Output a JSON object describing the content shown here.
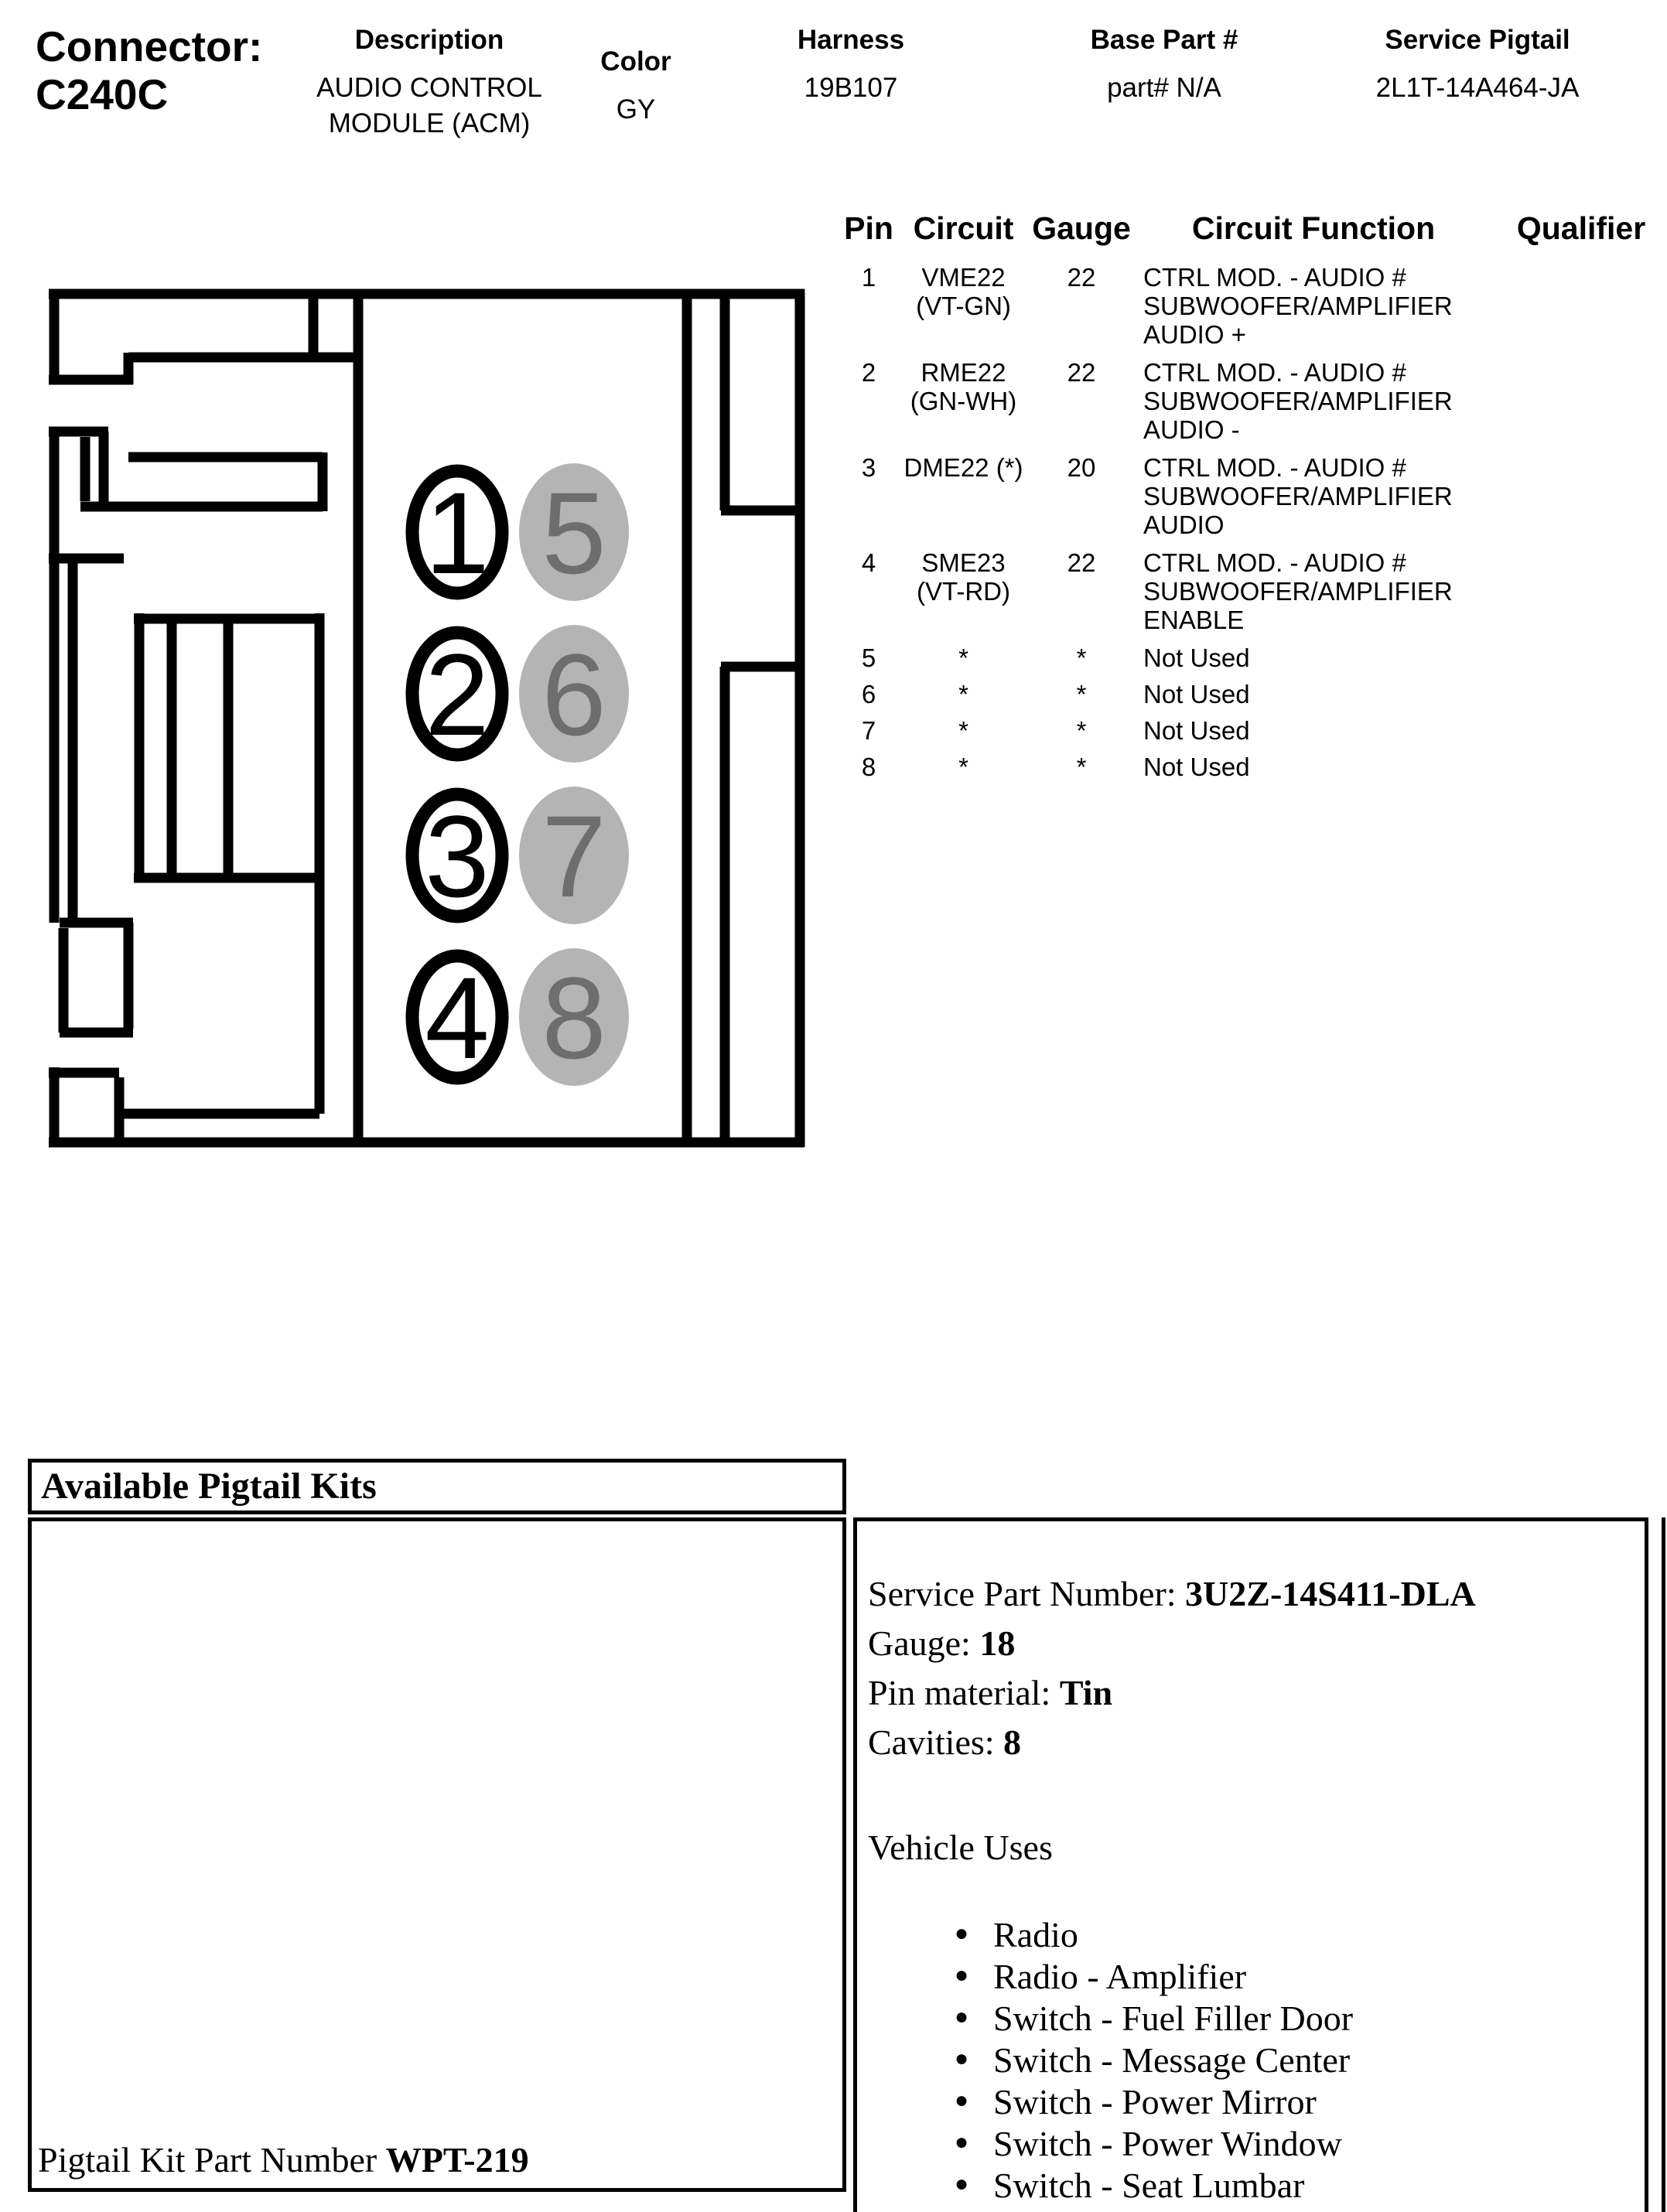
{
  "header": {
    "connector_label": "Connector:",
    "connector_id": "C240C",
    "description_label": "Description",
    "description_line1": "AUDIO CONTROL",
    "description_line2": "MODULE (ACM)",
    "color_label": "Color",
    "color_value": "GY",
    "harness_label": "Harness",
    "harness_value": "19B107",
    "base_part_label": "Base Part #",
    "base_part_value": "part# N/A",
    "service_pigtail_label": "Service Pigtail",
    "service_pigtail_value": "2L1T-14A464-JA"
  },
  "pin_table": {
    "headers": [
      "Pin",
      "Circuit",
      "Gauge",
      "Circuit Function",
      "Qualifier"
    ],
    "rows": [
      {
        "pin": "1",
        "circuit": [
          "VME22",
          "(VT-GN)"
        ],
        "gauge": "22",
        "function": [
          "CTRL MOD. - AUDIO #",
          "SUBWOOFER/AMPLIFIER",
          "AUDIO +"
        ],
        "qualifier": ""
      },
      {
        "pin": "2",
        "circuit": [
          "RME22",
          "(GN-WH)"
        ],
        "gauge": "22",
        "function": [
          "CTRL MOD. - AUDIO #",
          "SUBWOOFER/AMPLIFIER",
          "AUDIO -"
        ],
        "qualifier": ""
      },
      {
        "pin": "3",
        "circuit": [
          "DME22 (*)"
        ],
        "gauge": "20",
        "function": [
          "CTRL MOD. - AUDIO #",
          "SUBWOOFER/AMPLIFIER",
          "AUDIO"
        ],
        "qualifier": ""
      },
      {
        "pin": "4",
        "circuit": [
          "SME23",
          "(VT-RD)"
        ],
        "gauge": "22",
        "function": [
          "CTRL MOD. - AUDIO #",
          "SUBWOOFER/AMPLIFIER",
          "ENABLE"
        ],
        "qualifier": ""
      },
      {
        "pin": "5",
        "circuit": [
          "*"
        ],
        "gauge": "*",
        "function": [
          "Not Used"
        ],
        "qualifier": ""
      },
      {
        "pin": "6",
        "circuit": [
          "*"
        ],
        "gauge": "*",
        "function": [
          "Not Used"
        ],
        "qualifier": ""
      },
      {
        "pin": "7",
        "circuit": [
          "*"
        ],
        "gauge": "*",
        "function": [
          "Not Used"
        ],
        "qualifier": ""
      },
      {
        "pin": "8",
        "circuit": [
          "*"
        ],
        "gauge": "*",
        "function": [
          "Not Used"
        ],
        "qualifier": ""
      }
    ]
  },
  "connector_diagram": {
    "front_cavity_numbers": [
      "1",
      "2",
      "3",
      "4"
    ],
    "rear_cavity_numbers": [
      "5",
      "6",
      "7",
      "8"
    ],
    "outline_color": "#000000",
    "rear_cavity_fill": "#b4b4b4",
    "rear_cavity_number_color": "#6e6e6e"
  },
  "pigtail_section": {
    "title": "Available Pigtail Kits",
    "kit_part_label": "Pigtail Kit Part Number ",
    "kit_part_number": "WPT-219",
    "service_part_label": "Service Part Number: ",
    "service_part_number": "3U2Z-14S411-DLA",
    "gauge_label": "Gauge: ",
    "gauge_value": "18",
    "pin_material_label": "Pin material: ",
    "pin_material_value": "Tin",
    "cavities_label": "Cavities: ",
    "cavities_value": "8",
    "vehicle_uses_label": "Vehicle Uses",
    "vehicle_uses": [
      "Radio",
      "Radio - Amplifier",
      "Switch - Fuel Filler Door",
      "Switch - Message Center",
      "Switch - Power Mirror",
      "Switch - Power Window",
      "Switch - Seat Lumbar",
      "Switch - Steering Column Tilt/Telescope"
    ]
  }
}
